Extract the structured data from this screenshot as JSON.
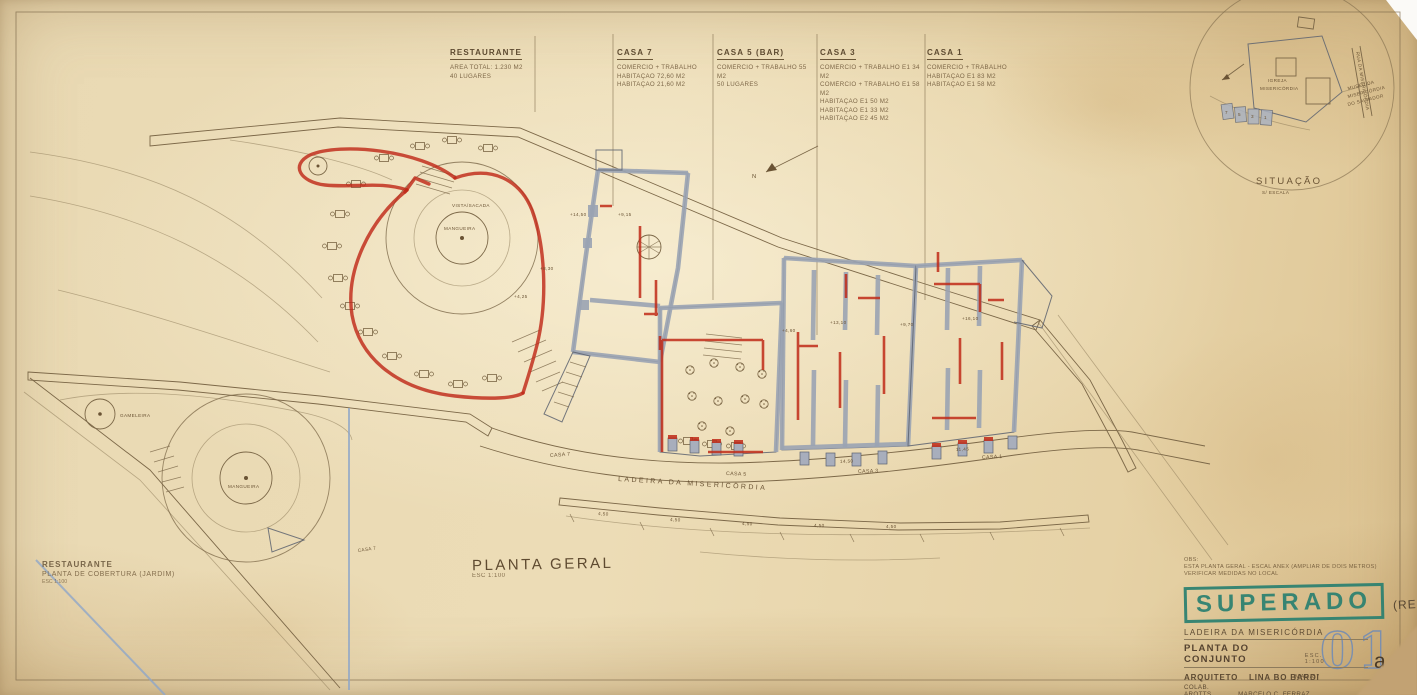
{
  "colors": {
    "paper": "#e9d8b2",
    "pencil": "#7c6848",
    "ink": "#6a5334",
    "wall_gray": "#9aa3b2",
    "red_marker": "#c02a18",
    "stamp_green": "#2a8070",
    "blue_pencil": "#8fa6c8"
  },
  "annotations": {
    "columns": [
      {
        "title": "RESTAURANTE",
        "lines": [
          "AREA TOTAL: 1.230 M2",
          "40 LUGARES"
        ]
      },
      {
        "title": "CASA 7",
        "lines": [
          "COMÉRCIO + TRABALHO",
          "HABITAÇÃO 72,60 M2",
          "HABITAÇÃO 21,60 M2"
        ]
      },
      {
        "title": "CASA 5 (BAR)",
        "lines": [
          "COMÉRCIO + TRABALHO 55 M2",
          "50 LUGARES"
        ]
      },
      {
        "title": "CASA 3",
        "lines": [
          "COMÉRCIO + TRABALHO E1 34 M2",
          "COMÉRCIO + TRABALHO E1 58 M2",
          "HABITAÇÃO E1 50 M2",
          "HABITAÇÃO E1 33 M2",
          "HABITAÇÃO E2 45 M2"
        ]
      },
      {
        "title": "CASA 1",
        "lines": [
          "COMÉRCIO + TRABALHO",
          "HABITAÇÃO E1 83 M2",
          "HABITAÇÃO E1 58 M2"
        ]
      }
    ]
  },
  "plan": {
    "title": "PLANTA GERAL",
    "scale": "ESC 1:100",
    "street": "LADEIRA DA MISERICÓRDIA",
    "north": "N",
    "terrace": {
      "center": "MANGUEIRA",
      "view": "VISTA/SACADA"
    },
    "houses": {
      "casa7": "CASA 7",
      "casa5": "CASA 5",
      "casa3": "CASA 3",
      "casa1": "CASA 1"
    },
    "dims": [
      "4,50",
      "4,50",
      "4,50",
      "4,50",
      "4,50"
    ],
    "street_dims": [
      "14,50",
      "11,45"
    ],
    "elevations": [
      "+14,50",
      "+9,15",
      "+8,30",
      "+4,25",
      "+13,10",
      "+9,70",
      "+4,60",
      "+16,10"
    ]
  },
  "garden": {
    "title": "RESTAURANTE",
    "subtitle": "PLANTA DE COBERTURA (JARDIM)",
    "scale": "ESC 1:100",
    "tree": "MANGUEIRA",
    "tree2": "GAMELEIRA",
    "casa7": "CASA 7"
  },
  "situacao": {
    "title": "SITUAÇÃO",
    "scale": "S/ ESCALA",
    "church1": "IGREJA",
    "church2": "MISERICÓRDIA",
    "side1": "MUSEU DA",
    "side2": "MISERICÓRDIA",
    "side3": "DO SALVADOR",
    "street": "RUA DA MISERICÓRDIA",
    "houses": [
      "7",
      "5",
      "3",
      "1"
    ]
  },
  "titleblock": {
    "obs1": "OBS:",
    "obs2": "ESTA PLANTA GERAL - ESCAL ANEX (AMPLIAR DE DOIS METROS)",
    "obs3": "VERIFICAR MEDIDAS NO LOCAL",
    "stamp": "SUPERADO",
    "stamp_note": "(REESTUDO)",
    "project": "LADEIRA DA MISERICÓRDIA",
    "sheet": "PLANTA DO CONJUNTO",
    "scale": "ESC. 1:100",
    "arch_label": "ARQUITETO",
    "architect": "LINA BO BARDI",
    "date": "MAR/87",
    "collab_label": "COLAB. ARQTTS",
    "collab1": "MARCELO C. FERRAZ",
    "collab2": "MARCELO SUZUKI",
    "number": "01",
    "rev": "a"
  }
}
